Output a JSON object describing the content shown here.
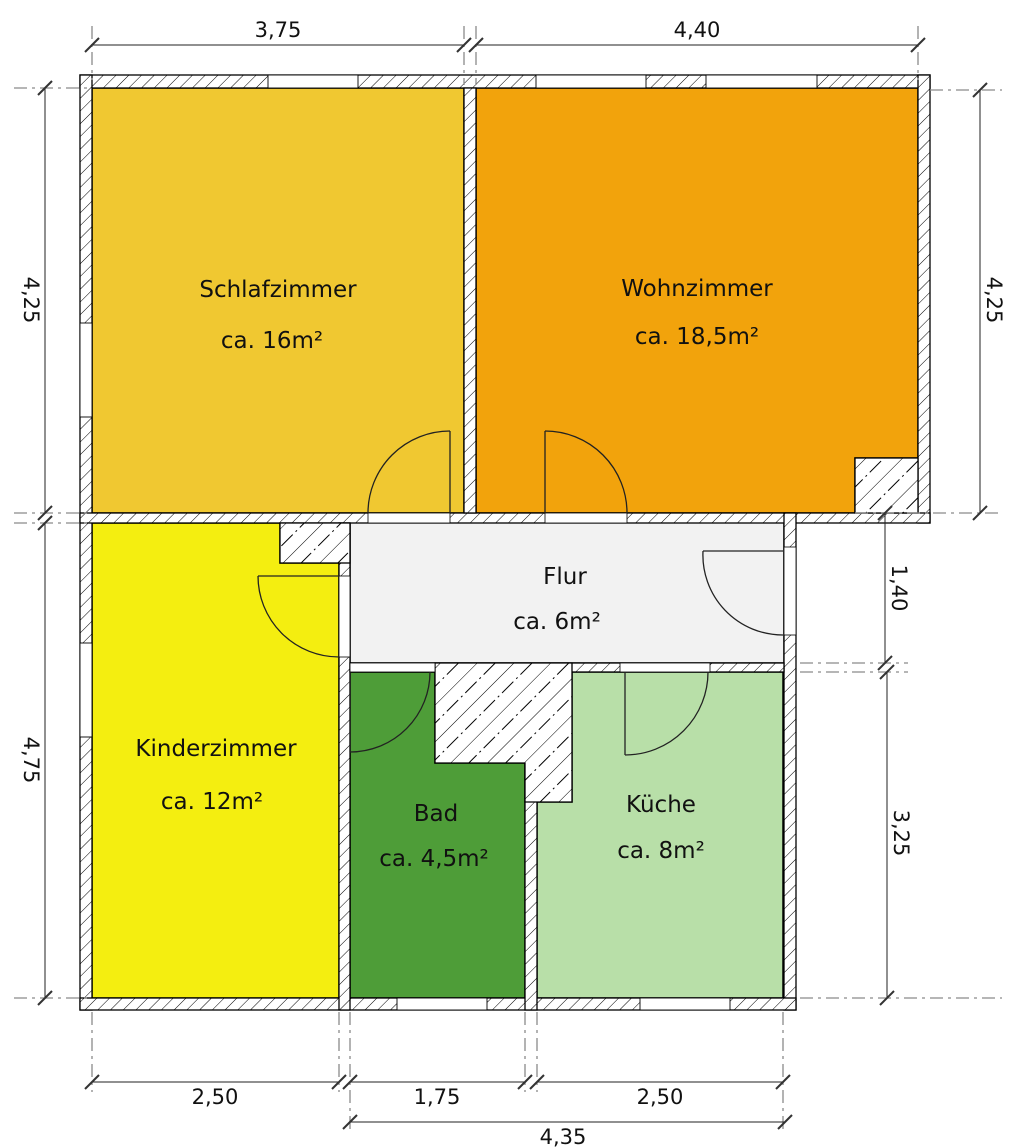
{
  "plan_title": "Wohnungsgrundriss",
  "rooms": {
    "schlafzimmer": {
      "name": "Schlafzimmer",
      "area": "ca. 16m²",
      "color": "#f0c831"
    },
    "wohnzimmer": {
      "name": "Wohnzimmer",
      "area": "ca. 18,5m²",
      "color": "#f2a30c"
    },
    "kinderzimmer": {
      "name": "Kinderzimmer",
      "area": "ca. 12m²",
      "color": "#f4ee10"
    },
    "bad": {
      "name": "Bad",
      "area": "ca. 4,5m²",
      "color": "#4e9d38"
    },
    "kueche": {
      "name": "Küche",
      "area": "ca. 8m²",
      "color": "#b8dfa8"
    },
    "flur": {
      "name": "Flur",
      "area": "ca. 6m²",
      "color": "#f2f2f2"
    }
  },
  "dims": {
    "top_left": "3,75",
    "top_right": "4,40",
    "left_upper": "4,25",
    "left_lower": "4,75",
    "right_upper": "4,25",
    "right_middle": "1,40",
    "right_lower": "3,25",
    "bottom_kinderzimmer": "2,50",
    "bottom_bad": "1,75",
    "bottom_kueche": "2,50",
    "bottom_total": "4,35"
  }
}
